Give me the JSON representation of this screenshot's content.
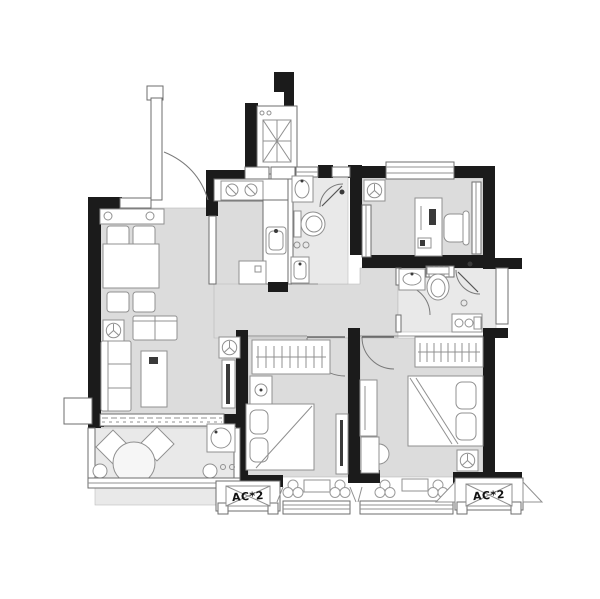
{
  "labels": {
    "ac_left": "AC*2",
    "ac_right": "AC*2"
  },
  "colors": {
    "wall": "#1b1b1b",
    "floor": "#dcdcdc",
    "floor_light": "#e9e9e9",
    "furniture_stroke": "#909090",
    "background": "#ffffff",
    "door_arc": "#7a7a7a"
  },
  "icons": {
    "elevator-icon": "box with X cross",
    "fan-coil-icon": "square with circle and 3 spokes",
    "stove-icon": "two burner circles",
    "plant-icon": "three-petal flower",
    "hanger-icon": "strokes on rail",
    "washer-icon": "box with drum circle"
  }
}
